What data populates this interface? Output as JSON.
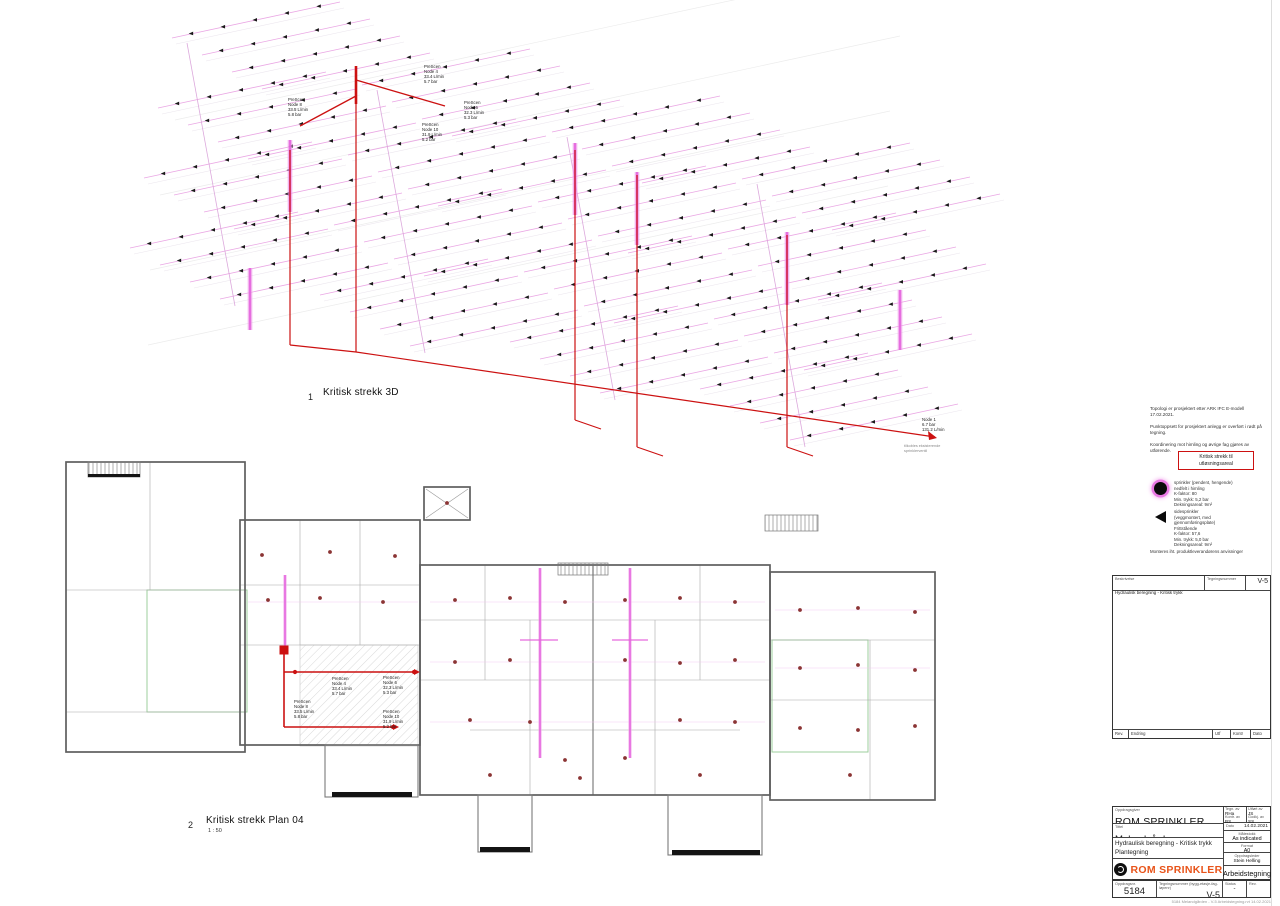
{
  "colors": {
    "red": "#cc1111",
    "pink": "#e9a3e3",
    "pink_light": "#f3c6ef",
    "magenta": "#e564dd",
    "green": "#9ccf9c",
    "dot": "#8b3434",
    "wall": "#5f5f5f",
    "wall_light": "#a8a8a8",
    "logo_orange": "#e8541a"
  },
  "views": {
    "view1": {
      "number": "1",
      "title": "Kritisk strekk 3D"
    },
    "view2": {
      "number": "2",
      "title": "Kritisk strekk Plan 04",
      "scale": "1 : 50"
    }
  },
  "nodes": {
    "n4": {
      "scen": "PreScen",
      "name": "Node 4",
      "flow": "33.4 L/min",
      "pressure": "5.7 bar"
    },
    "n6": {
      "scen": "PreScen",
      "name": "Node 6",
      "flow": "32.3 L/min",
      "pressure": "5.3 bar"
    },
    "n8": {
      "scen": "PreScen",
      "name": "Node 8",
      "flow": "33.5 L/min",
      "pressure": "5.8 bar"
    },
    "n10": {
      "scen": "PreScen",
      "name": "Node 10",
      "flow": "31.9 L/min",
      "pressure": "5.2 bar"
    },
    "n1": {
      "name": "Node 1",
      "pressure": "6.7 bar",
      "flow": "131.2 L/min",
      "note1": "tilkobles eksisterende",
      "note2": "sprinklerventil"
    }
  },
  "notes": {
    "p1": "Topologi er prosjektert etter ARK IFC E-modell 17.02.2021.",
    "p2": "Punktoppsett for prosjektert anlegg er overført i rødt på tegning.",
    "p3": "Koordinering mot himling og øvrige fag gjøres av utførende."
  },
  "legend": {
    "title_line1": "Kritisk strekk til",
    "title_line2": "utløsningsareal",
    "item1": {
      "l1": "sprinkler (pendent, hengende)",
      "l2": "nedfelt i himling",
      "l3": "K-faktor: 80",
      "l4": "Min. trykk: 5,2 bar",
      "l5": "Dekningsareal: 9m²"
    },
    "item2": {
      "l1": "sidesprinkler",
      "l2": "(veggmontert, med gjennomføringsplate)",
      "l3": "Frittstående",
      "l4": "K-faktor: 57,6",
      "l5": "Min. trykk: 5,0 bar",
      "l6": "Dekningsareal: 9m²"
    },
    "footnote": "Monteres iht. produktleverandørens anvisninger"
  },
  "titleblock": {
    "upper": {
      "desc_label": "Beskrivelse",
      "desc": "Hydraulisk beregning - Kritisk trykk",
      "dn_label": "Tegningsnummer",
      "dn": "V-5",
      "rev_h1": "Rev.",
      "rev_h2": "Endring",
      "rev_h3": "Utf",
      "rev_h4": "Kontr",
      "rev_h5": "Dato"
    },
    "company_label": "Oppdragsgiver",
    "company": "ROM SPRINKLER",
    "project_label": "Tittel",
    "project": "Melandgården",
    "desc1": "Hydraulisk beregning - Kritisk trykk",
    "desc2": "Plantegning",
    "fields": {
      "drawn_label": "Tegn. av",
      "drawn": "RHa",
      "made_label": "Utført av",
      "made": "JS",
      "checked_label": "Kontr. av",
      "checked": "BS",
      "approved_label": "Godkj. av",
      "approved": "SS",
      "date_label": "Dato",
      "date": "14.02.2021",
      "scale_label": "Målestokk",
      "scale": "As indicated",
      "format_label": "Format",
      "format": "A0",
      "lead_label": "Oppdragsleder",
      "lead": "Stein Helling"
    },
    "logo_text": "ROM SPRINKLER",
    "status": "Arbeidstegning",
    "bottom": {
      "projno_label": "Oppdragsnr.",
      "projno": "5184",
      "dn_label": "Tegningsnummer (bygg-etasje-fag-løpenr)",
      "dn": "V-5",
      "status_label": "Status",
      "status": "-",
      "rev_label": "Rev."
    }
  },
  "footer": {
    "path": "5184 Melandgården - V-5 Arbeidstegning.rvt    14.02.2021"
  }
}
